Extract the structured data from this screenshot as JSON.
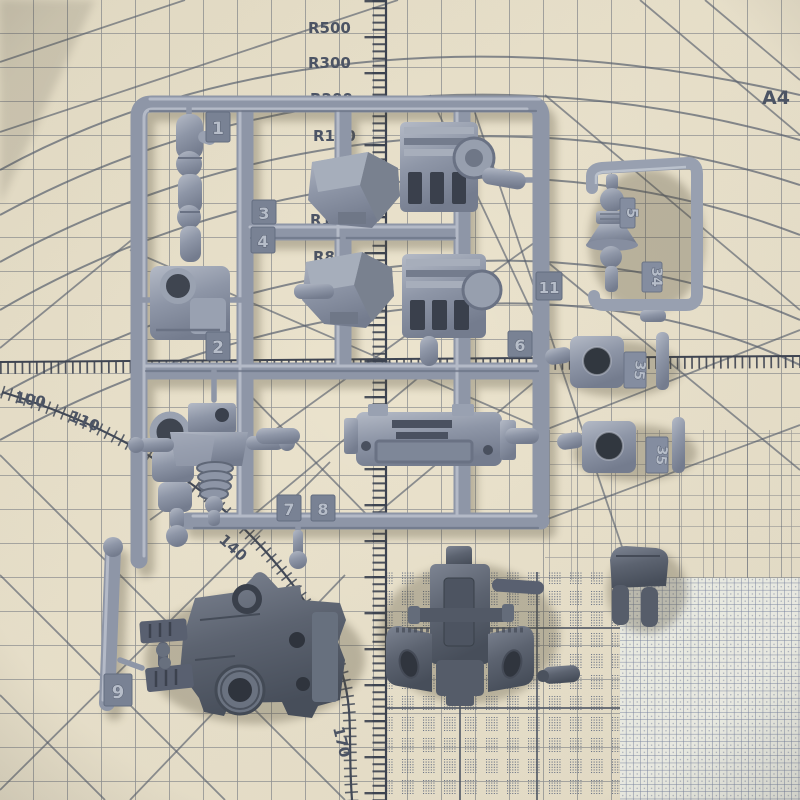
{
  "photo": {
    "mat": {
      "size_label": "A4",
      "radius_labels": [
        "R500",
        "R300",
        "R200",
        "R150",
        "R100",
        "R80"
      ],
      "curve_numbers": [
        "100",
        "110",
        "140",
        "150",
        "160",
        "170"
      ],
      "surface_color": "#e9e1cb",
      "line_color": "#59616f",
      "ruler_color": "#3c4350",
      "label_color": "#4d5566"
    },
    "main_sprue": {
      "plastic_color": "#8e96a7",
      "gate_tags": [
        "1",
        "2",
        "3",
        "4",
        "6",
        "7",
        "8",
        "9",
        "11"
      ]
    },
    "small_runner": {
      "plastic_color": "#98a0b0",
      "gate_tags": [
        "5",
        "34"
      ]
    },
    "loose_light_parts": {
      "gate_tags": [
        "35",
        "35"
      ]
    },
    "loose_dark_parts": {
      "plastic_color": "#5b6270"
    }
  }
}
